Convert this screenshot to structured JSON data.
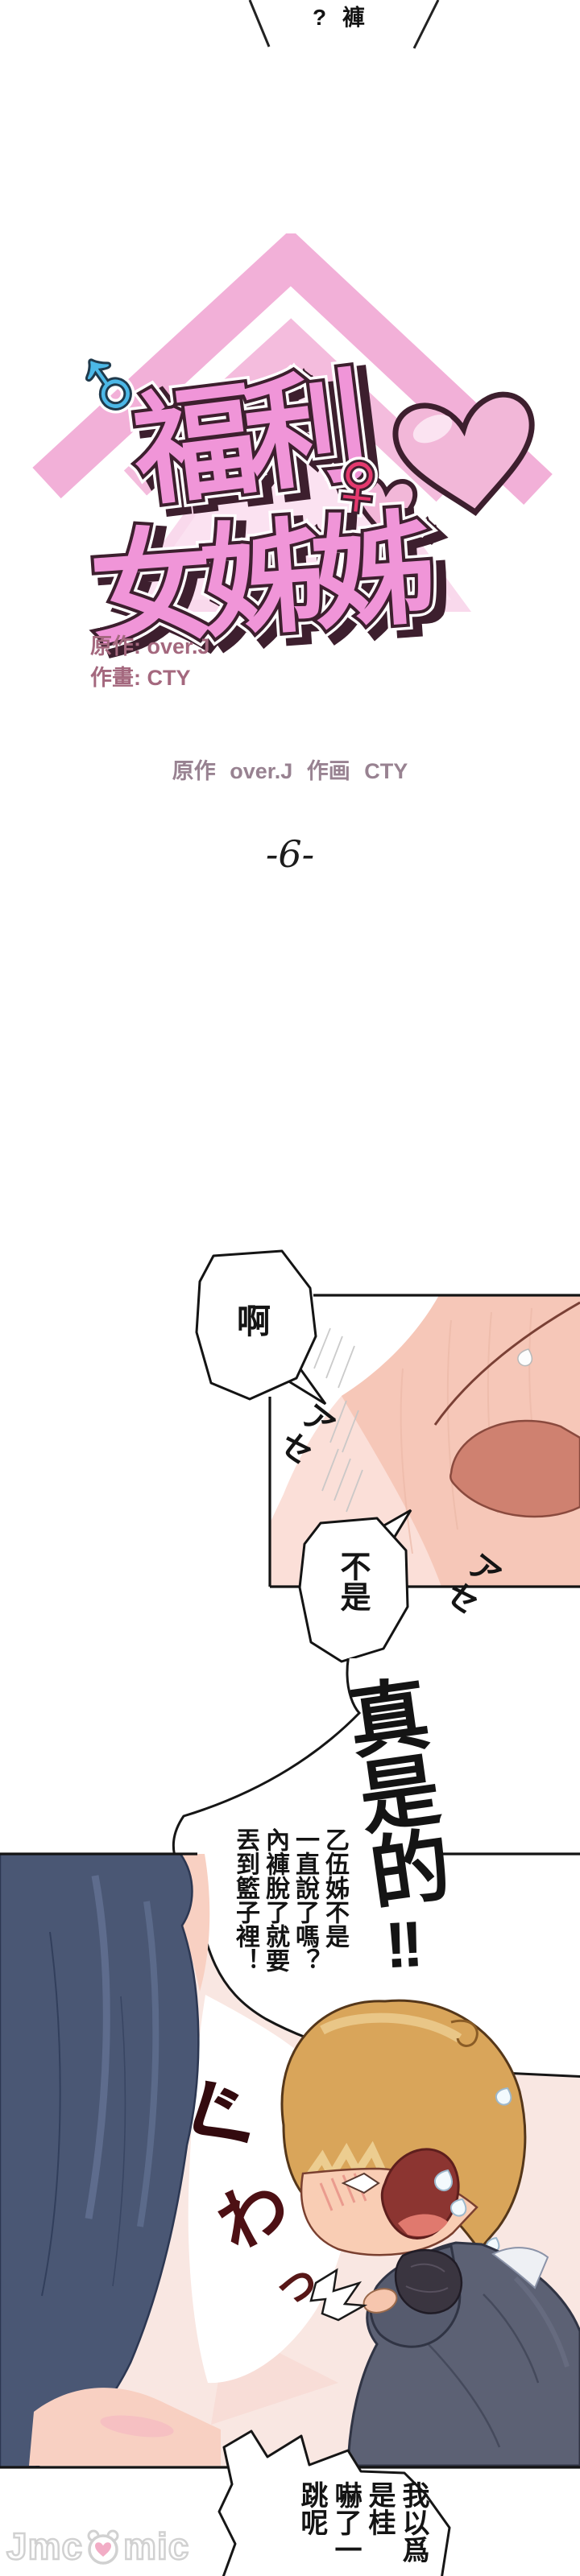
{
  "top_fragment": {
    "text": "? 褲"
  },
  "logo": {
    "line1": "福利",
    "line2": "女姊姊",
    "male_symbol": "♂",
    "female_symbol": "♀"
  },
  "credits": {
    "original": "原作: over.J",
    "artist": "作畫: CTY",
    "center": "原作 over.J 作画 CTY",
    "episode": "-6-"
  },
  "panel1": {
    "bubble_ah": "啊",
    "bubble_not": "不是",
    "sfx_sweat_1": "アセ",
    "sfx_sweat_2": "アセ"
  },
  "panel2": {
    "shout": "真是的",
    "shout_bang": "!!",
    "speech_cols": [
      "乙伍姊不是",
      "一直說了嗎？",
      "內褲脫了就要",
      "丟到籃子裡！"
    ],
    "sfx_gu": "ぐ",
    "sfx_wa": "わ",
    "sfx_tsu": "っ"
  },
  "bottom_bubble": {
    "col_right": "我以爲是桂",
    "col_left": "嚇了一跳呢"
  },
  "watermark": {
    "prefix": "Jmc",
    "suffix": "mic"
  },
  "colors": {
    "title_pink": "#f095d8",
    "outline_maroon": "#3d1f2e",
    "chevron_pink": "#f2b0d8",
    "male_blue": "#4cb8e7",
    "female_crimson": "#e4396e",
    "credit_mauve": "#a4687e",
    "center_credit_gray": "#988291",
    "panel_bg_pink": "#f9e7e2",
    "skin": "#f6c7b8",
    "rose_patch": "#cf8170",
    "hair_navy": "#4a5774",
    "hair_blond": "#d9a55a",
    "jacket_gray": "#5c6174",
    "sfx_dark_red": "#43100f",
    "watermark_gray": "#cfcfcf"
  }
}
